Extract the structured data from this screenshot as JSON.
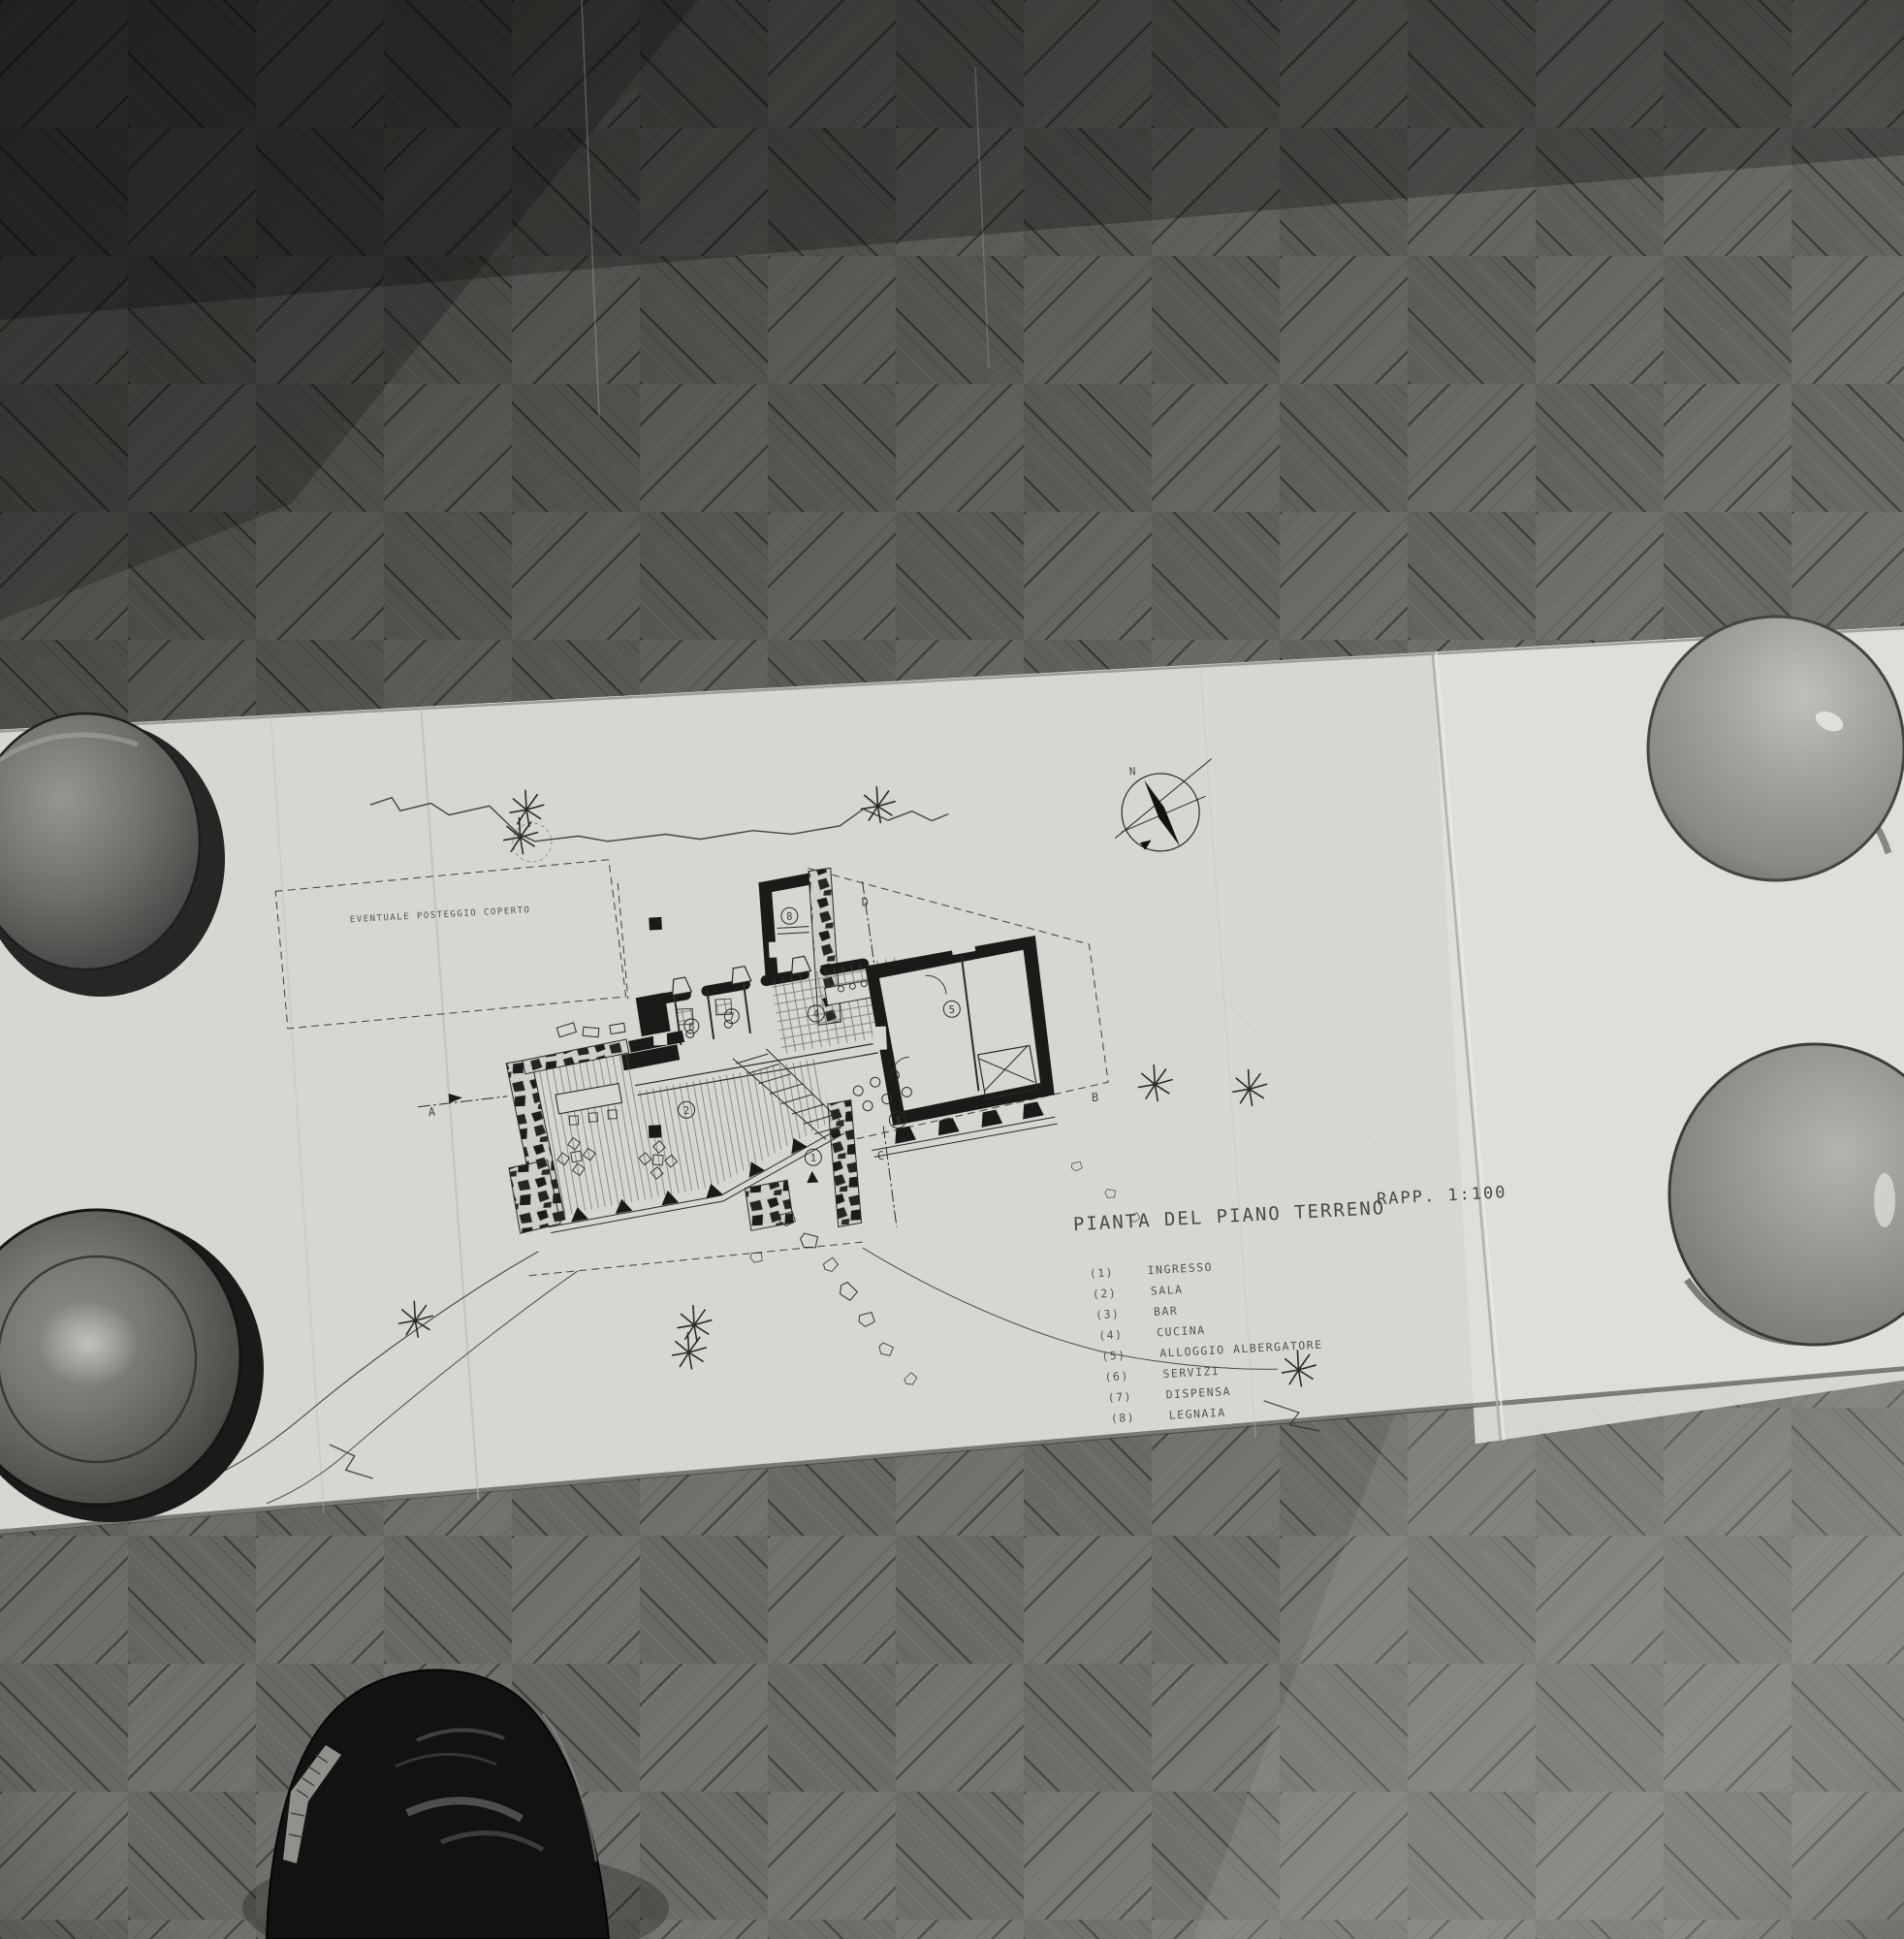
{
  "drawing": {
    "title": "PIANTA DEL PIANO TERRENO",
    "scale": "RAPP. 1:100",
    "site_note": "EVENTUALE POSTEGGIO COPERTO",
    "north": "N",
    "sections": {
      "a": "A",
      "b": "B",
      "c": "C",
      "d": "D"
    },
    "legend": {
      "items": [
        {
          "tag": "(1)",
          "n": "1",
          "label": "INGRESSO"
        },
        {
          "tag": "(2)",
          "n": "2",
          "label": "SALA"
        },
        {
          "tag": "(3)",
          "n": "3",
          "label": "BAR"
        },
        {
          "tag": "(4)",
          "n": "4",
          "label": "CUCINA"
        },
        {
          "tag": "(5)",
          "n": "5",
          "label": "ALLOGGIO ALBERGATORE"
        },
        {
          "tag": "(6)",
          "n": "6",
          "label": "SERVIZI"
        },
        {
          "tag": "(7)",
          "n": "7",
          "label": "DISPENSA"
        },
        {
          "tag": "(8)",
          "n": "8",
          "label": "LEGNAIA"
        }
      ]
    }
  },
  "colors": {
    "paper": "#d7d6d1",
    "paper_right_panel": "#e0dfda",
    "ink": "#2b2a27",
    "floor_mid": "#716f6b",
    "shoe": "#121212"
  }
}
